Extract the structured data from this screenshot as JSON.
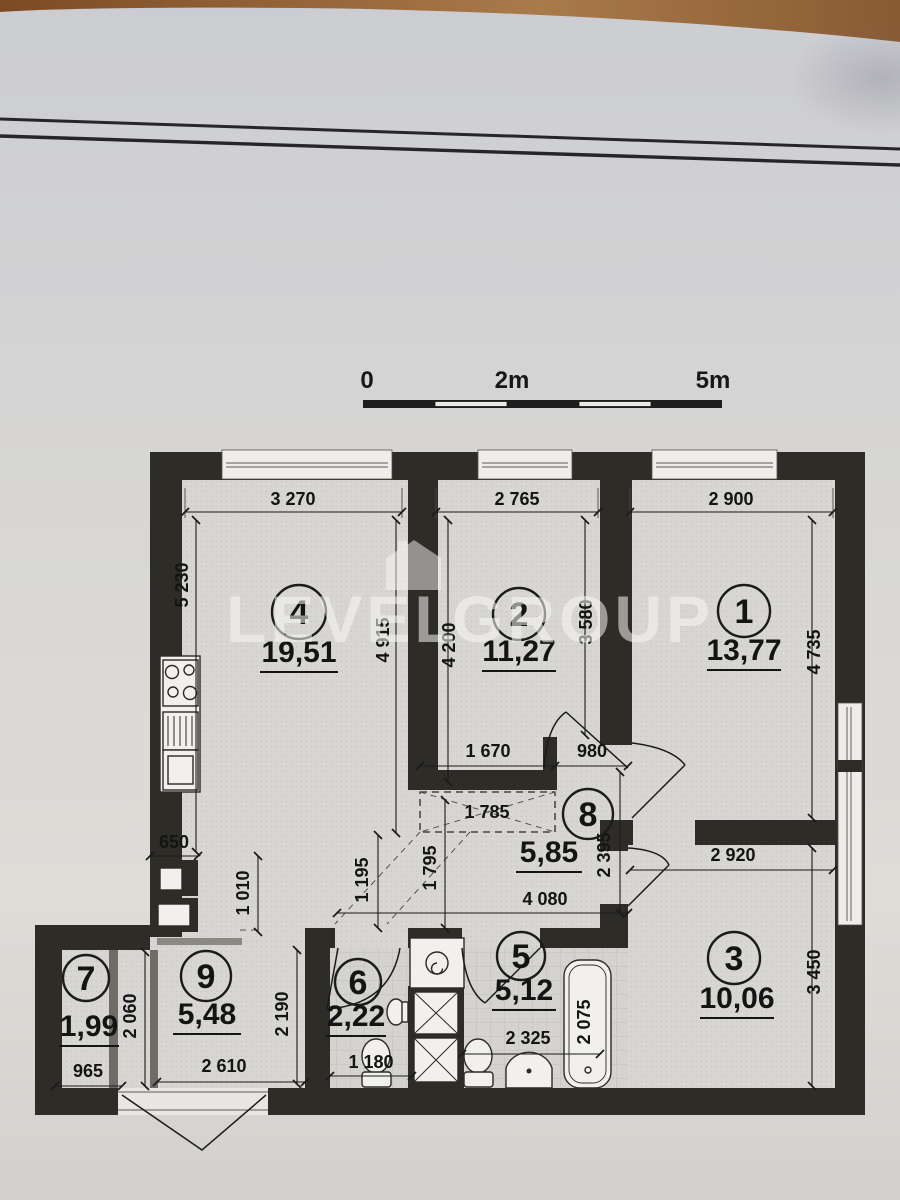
{
  "watermark": {
    "left": "LEVEL",
    "right": "GROUP",
    "logo": "house-icon"
  },
  "scale_bar": {
    "start": "0",
    "mid": "2m",
    "end": "5m"
  },
  "rooms": {
    "r1": {
      "number": "1",
      "area": "13,77"
    },
    "r2": {
      "number": "2",
      "area": "11,27"
    },
    "r3": {
      "number": "3",
      "area": "10,06"
    },
    "r4": {
      "number": "4",
      "area": "19,51"
    },
    "r5": {
      "number": "5",
      "area": "5,12"
    },
    "r6": {
      "number": "6",
      "area": "2,22"
    },
    "r7": {
      "number": "7",
      "area": "1,99"
    },
    "r8": {
      "number": "8",
      "area": "5,85"
    },
    "r9": {
      "number": "9",
      "area": "5,48"
    }
  },
  "dims": {
    "top_room4": "3 270",
    "top_room2": "2 765",
    "top_room1": "2 900",
    "left_height": "5 230",
    "room4_height": "4 915",
    "room2_left_height": "4 200",
    "room2_right_height": "3 580",
    "room1_height": "4 735",
    "hall_niche_width": "1 670",
    "door_width": "980",
    "wardrobe_width": "1 785",
    "corridor_left_height": "1 195",
    "corridor_right_height": "1 795",
    "hall_width": "4 080",
    "hall_height": "2 395",
    "room3_width": "2 920",
    "room3_height": "3 450",
    "kitchen_counter": "650",
    "kitchen_depth": "1 010",
    "room7_width": "965",
    "room7_height": "2 060",
    "room9_width": "2 610",
    "room9_height": "2 190",
    "room6_width": "1 180",
    "room5_width": "2 325",
    "bath_length": "2 075"
  },
  "colors": {
    "wall": "#2e2c27",
    "paper": "#d7d5d1",
    "wood": "#96653a"
  },
  "fixtures": [
    "stove-icon",
    "kitchen-sink-icon",
    "cabinet-icon",
    "washing-machine-icon",
    "toilet-icon",
    "toilet-icon",
    "washbasin-icon",
    "corner-sink-icon",
    "bathtub-icon"
  ]
}
